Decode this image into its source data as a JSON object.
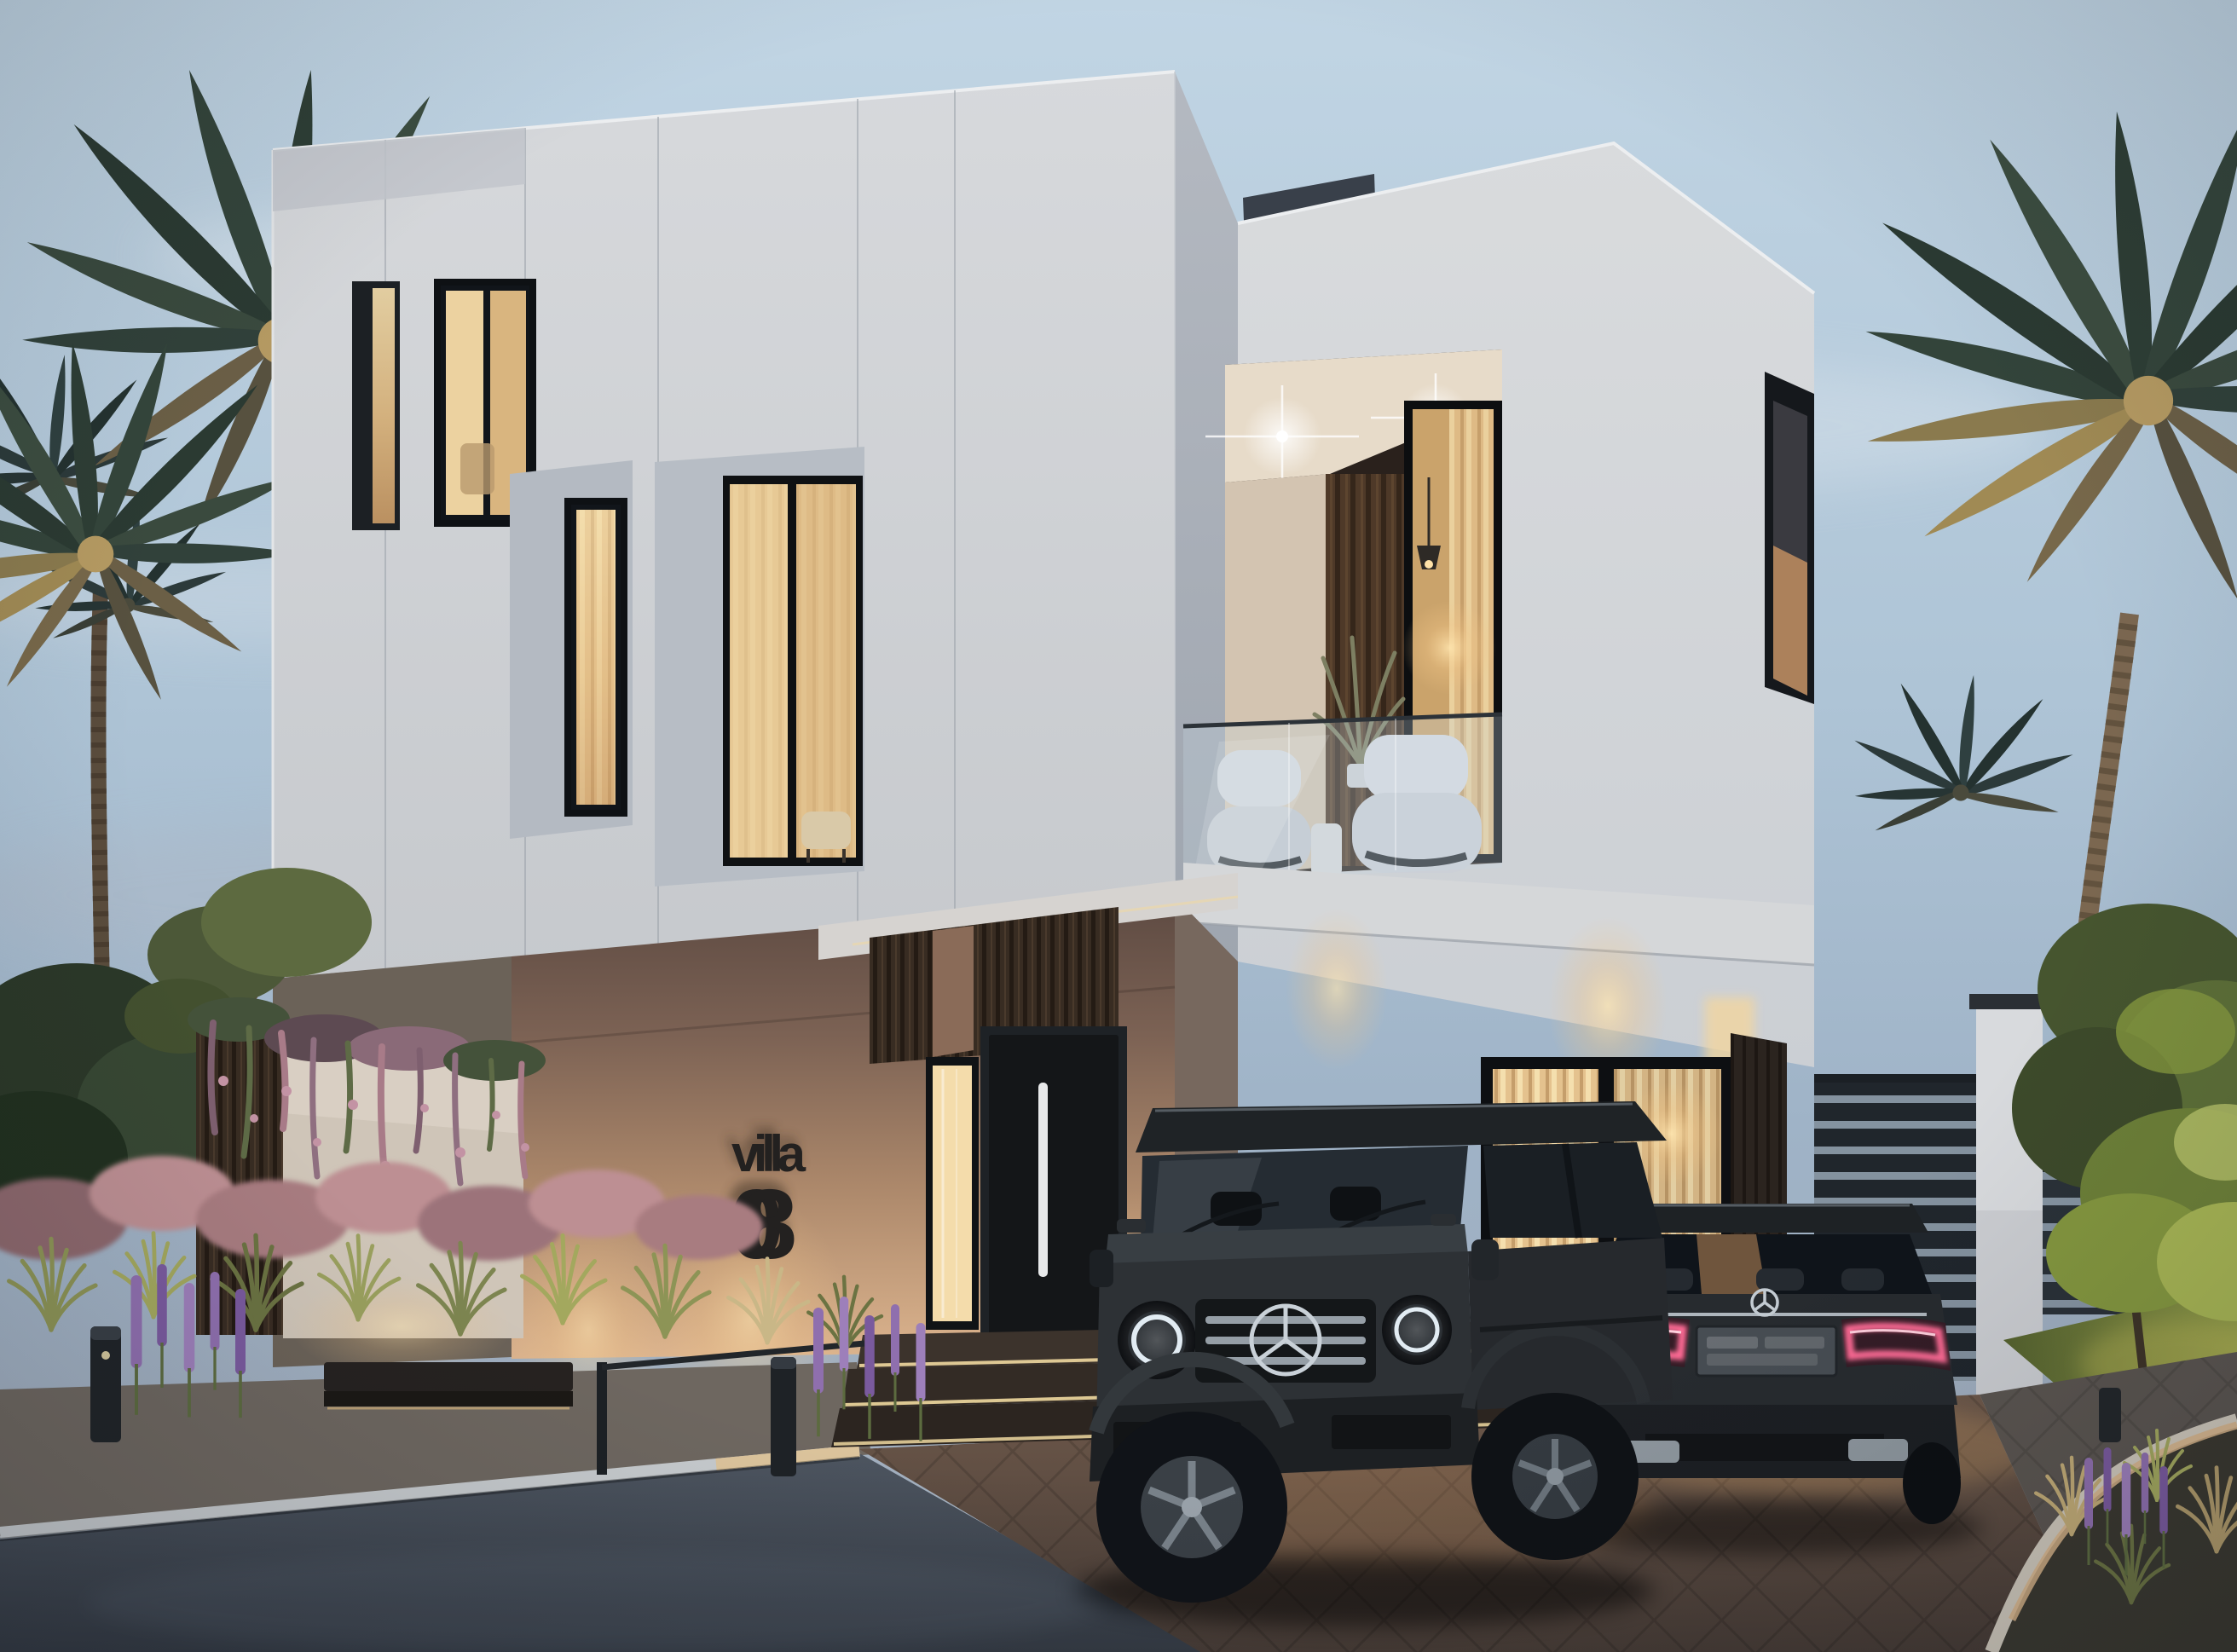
{
  "scene": {
    "villa_sign": {
      "line1": "villa",
      "line2": "08"
    }
  },
  "icons": {
    "suv_badge": "mercedes-star-icon",
    "sedan_badge": "mercedes-star-icon"
  },
  "colors": {
    "sky_top": "#bed3e3",
    "sky_mid": "#a9bfd2",
    "sky_horizon": "#9fb0c2",
    "facade_light": "#d6d8db",
    "facade_shadow": "#aeb4bd",
    "roof_box": "#39404a",
    "entrance_wall_dark": "#5f4c44",
    "entrance_wall_glow": "#d8b28c",
    "wood_cladding": "#382c22",
    "balcony_wood": "#4e3928",
    "window_frame": "#121417",
    "window_glow": "#ecd0a0",
    "curtain": "#e6c794",
    "glass_railing": "#c7d6e0",
    "armchair": "#c9cdd4",
    "sign_text": "#232120",
    "suv_body": "#2e3236",
    "sedan_body": "#272b2f",
    "taillight_glow": "#ff6b95",
    "headlight_drl": "#dfeaf2",
    "chrome": "#c9d1d8",
    "street": "#454d58",
    "curb": "#c8ccd0",
    "curb_warm": "#d8b488",
    "paver_warm": "#64503f",
    "paver_cool": "#555052",
    "grass_green": "#5d6b3a",
    "lawn_lit": "#8f9a48",
    "bush_pink": "#bf8f96",
    "flower_purple": "#8f6fae",
    "palm_dark": "#2e3d35",
    "palm_gold": "#b1945c",
    "tree_lit": "#97a94f",
    "gate_slat": "#232930",
    "bollard": "#23262a"
  }
}
